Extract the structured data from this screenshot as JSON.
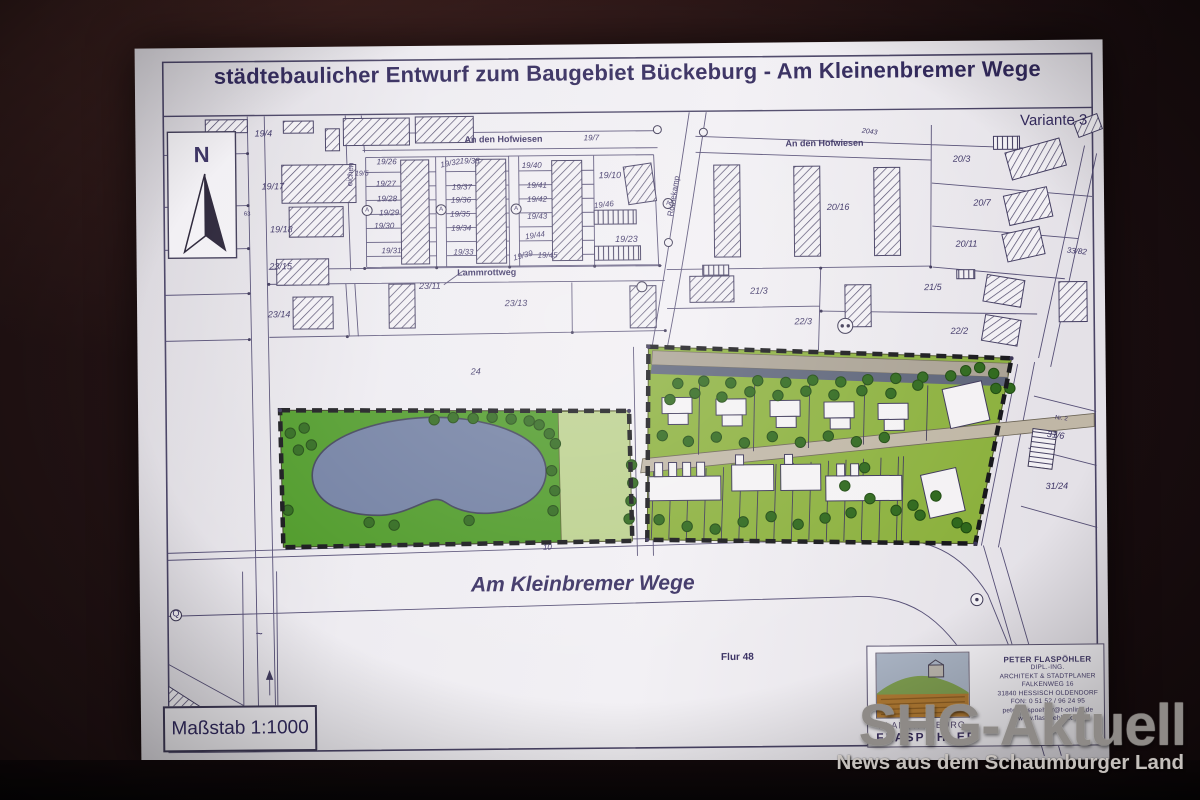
{
  "watermark": {
    "title": "SHG-Aktuell",
    "subtitle": "News aus dem Schaumburger Land"
  },
  "plan": {
    "title": "städtebaulicher Entwurf zum Baugebiet Bückeburg - Am Kleinenbremer Wege",
    "variant": "Variante 3",
    "scale": "Maßstab 1:1000",
    "colors": {
      "line": "#4a4466",
      "park_green": "#4e9a28",
      "parcel_green": "#8cb13e",
      "light_green": "#bcd18e",
      "pond": "#717fa2",
      "road_tan": "#b3ab9c",
      "road_dark": "#5d6479",
      "boundary": "#17171b"
    },
    "map_labels": [
      {
        "t": "An den Hofwiesen",
        "x": 508,
        "y": 141,
        "s": 9,
        "b": 1
      },
      {
        "t": "19/7",
        "x": 596,
        "y": 140,
        "s": 8,
        "i": 1
      },
      {
        "t": "An den Hofwiesen",
        "x": 829,
        "y": 148,
        "s": 9,
        "b": 1
      },
      {
        "t": "2043",
        "x": 874,
        "y": 136,
        "s": 7,
        "i": 1,
        "r": 8
      },
      {
        "t": "Lammrottweg",
        "x": 490,
        "y": 274,
        "s": 9,
        "b": 1
      },
      {
        "t": "Röthekamp",
        "x": 680,
        "y": 197,
        "s": 8,
        "r": -80
      },
      {
        "t": "eichen",
        "x": 357,
        "y": 172,
        "s": 8,
        "r": -86
      },
      {
        "t": "Am Kleinbremer Wege",
        "x": 583,
        "y": 590,
        "s": 21,
        "b": 1,
        "i": 1
      },
      {
        "t": "Flur 48",
        "x": 737,
        "y": 661,
        "s": 10,
        "b": 1
      },
      {
        "t": "N",
        "x": 206,
        "y": 158,
        "s": 22,
        "b": 1
      },
      {
        "t": "19/4",
        "x": 268,
        "y": 133,
        "s": 9,
        "i": 1
      },
      {
        "t": "19/17",
        "x": 277,
        "y": 186,
        "s": 9,
        "i": 1
      },
      {
        "t": "19/18",
        "x": 285,
        "y": 229,
        "s": 9,
        "i": 1
      },
      {
        "t": "23/15",
        "x": 284,
        "y": 266,
        "s": 9,
        "i": 1
      },
      {
        "t": "23/14",
        "x": 282,
        "y": 314,
        "s": 9,
        "i": 1
      },
      {
        "t": "19/5",
        "x": 366,
        "y": 173,
        "s": 7,
        "i": 1
      },
      {
        "t": "63",
        "x": 251,
        "y": 212,
        "s": 6
      },
      {
        "t": "19/26",
        "x": 391,
        "y": 162,
        "s": 8,
        "i": 1
      },
      {
        "t": "19/27",
        "x": 390,
        "y": 184,
        "s": 8,
        "i": 1
      },
      {
        "t": "19/28",
        "x": 391,
        "y": 199,
        "s": 8,
        "i": 1
      },
      {
        "t": "19/29",
        "x": 393,
        "y": 213,
        "s": 8,
        "i": 1
      },
      {
        "t": "19/30",
        "x": 388,
        "y": 226,
        "s": 8,
        "i": 1
      },
      {
        "t": "19/31",
        "x": 395,
        "y": 251,
        "s": 8,
        "i": 1
      },
      {
        "t": "19/32",
        "x": 455,
        "y": 164,
        "s": 8,
        "i": 1,
        "r": -10
      },
      {
        "t": "19/38",
        "x": 474,
        "y": 162,
        "s": 8,
        "i": 1
      },
      {
        "t": "19/37",
        "x": 466,
        "y": 188,
        "s": 8,
        "i": 1
      },
      {
        "t": "19/36",
        "x": 465,
        "y": 201,
        "s": 8,
        "i": 1
      },
      {
        "t": "19/35",
        "x": 464,
        "y": 215,
        "s": 8,
        "i": 1
      },
      {
        "t": "19/34",
        "x": 465,
        "y": 229,
        "s": 8,
        "i": 1
      },
      {
        "t": "19/33",
        "x": 467,
        "y": 253,
        "s": 8,
        "i": 1
      },
      {
        "t": "19/40",
        "x": 536,
        "y": 167,
        "s": 8,
        "i": 1
      },
      {
        "t": "19/41",
        "x": 541,
        "y": 187,
        "s": 8,
        "i": 1
      },
      {
        "t": "19/42",
        "x": 541,
        "y": 201,
        "s": 8,
        "i": 1
      },
      {
        "t": "19/43",
        "x": 541,
        "y": 218,
        "s": 8,
        "i": 1
      },
      {
        "t": "19/44",
        "x": 539,
        "y": 237,
        "s": 8,
        "i": 1,
        "r": -8
      },
      {
        "t": "19/39",
        "x": 527,
        "y": 257,
        "s": 8,
        "i": 1,
        "r": -14
      },
      {
        "t": "19/45",
        "x": 551,
        "y": 257,
        "s": 8,
        "i": 1
      },
      {
        "t": "19/10",
        "x": 614,
        "y": 178,
        "s": 9,
        "i": 1
      },
      {
        "t": "19/46",
        "x": 608,
        "y": 207,
        "s": 8,
        "i": 1,
        "r": -6
      },
      {
        "t": "19/23",
        "x": 630,
        "y": 242,
        "s": 9,
        "i": 1
      },
      {
        "t": "20/3",
        "x": 966,
        "y": 165,
        "s": 9,
        "i": 1
      },
      {
        "t": "20/16",
        "x": 842,
        "y": 212,
        "s": 9,
        "i": 1
      },
      {
        "t": "20/7",
        "x": 986,
        "y": 209,
        "s": 9,
        "i": 1
      },
      {
        "t": "20/11",
        "x": 970,
        "y": 250,
        "s": 9,
        "i": 1
      },
      {
        "t": "33/82",
        "x": 1080,
        "y": 258,
        "s": 8,
        "i": 1,
        "r": 6
      },
      {
        "t": "21/3",
        "x": 762,
        "y": 295,
        "s": 9,
        "i": 1
      },
      {
        "t": "21/5",
        "x": 936,
        "y": 293,
        "s": 9,
        "i": 1
      },
      {
        "t": "22/3",
        "x": 806,
        "y": 326,
        "s": 9,
        "i": 1
      },
      {
        "t": "22/2",
        "x": 962,
        "y": 337,
        "s": 9,
        "i": 1
      },
      {
        "t": "23/11",
        "x": 433,
        "y": 287,
        "s": 9,
        "i": 1
      },
      {
        "t": "23/13",
        "x": 519,
        "y": 305,
        "s": 9,
        "i": 1
      },
      {
        "t": "24",
        "x": 478,
        "y": 373,
        "s": 9,
        "i": 1
      },
      {
        "t": "10",
        "x": 548,
        "y": 549,
        "s": 8,
        "i": 1
      },
      {
        "t": "Nr. 2",
        "x": 1063,
        "y": 424,
        "s": 6,
        "r": 8
      },
      {
        "t": "31/6",
        "x": 1057,
        "y": 442,
        "s": 9,
        "i": 1,
        "r": 8
      },
      {
        "t": "31/24",
        "x": 1058,
        "y": 493,
        "s": 9,
        "i": 1
      },
      {
        "t": "Q",
        "x": 176,
        "y": 612,
        "s": 9
      },
      {
        "t": "~",
        "x": 259,
        "y": 634,
        "s": 12
      },
      {
        "t": "A",
        "x": 371,
        "y": 209,
        "s": 6
      },
      {
        "t": "A",
        "x": 445,
        "y": 209,
        "s": 6
      },
      {
        "t": "A",
        "x": 520,
        "y": 209,
        "s": 6
      },
      {
        "t": "A",
        "x": 672,
        "y": 205,
        "s": 6
      }
    ]
  },
  "architect": {
    "office_line1": "PLANUNGSBÜRO",
    "office_line2": "FLASPÖHLER",
    "name": "PETER FLASPÖHLER",
    "details": [
      "DIPL.-ING.",
      "ARCHITEKT & STADTPLANER",
      "FALKENWEG 16",
      "31840 HESSISCH OLDENDORF",
      "FON: 0 51 52 / 96 24 95",
      "peter.flaspoehler@t-online.de",
      "www.flaspoehler.de"
    ]
  }
}
